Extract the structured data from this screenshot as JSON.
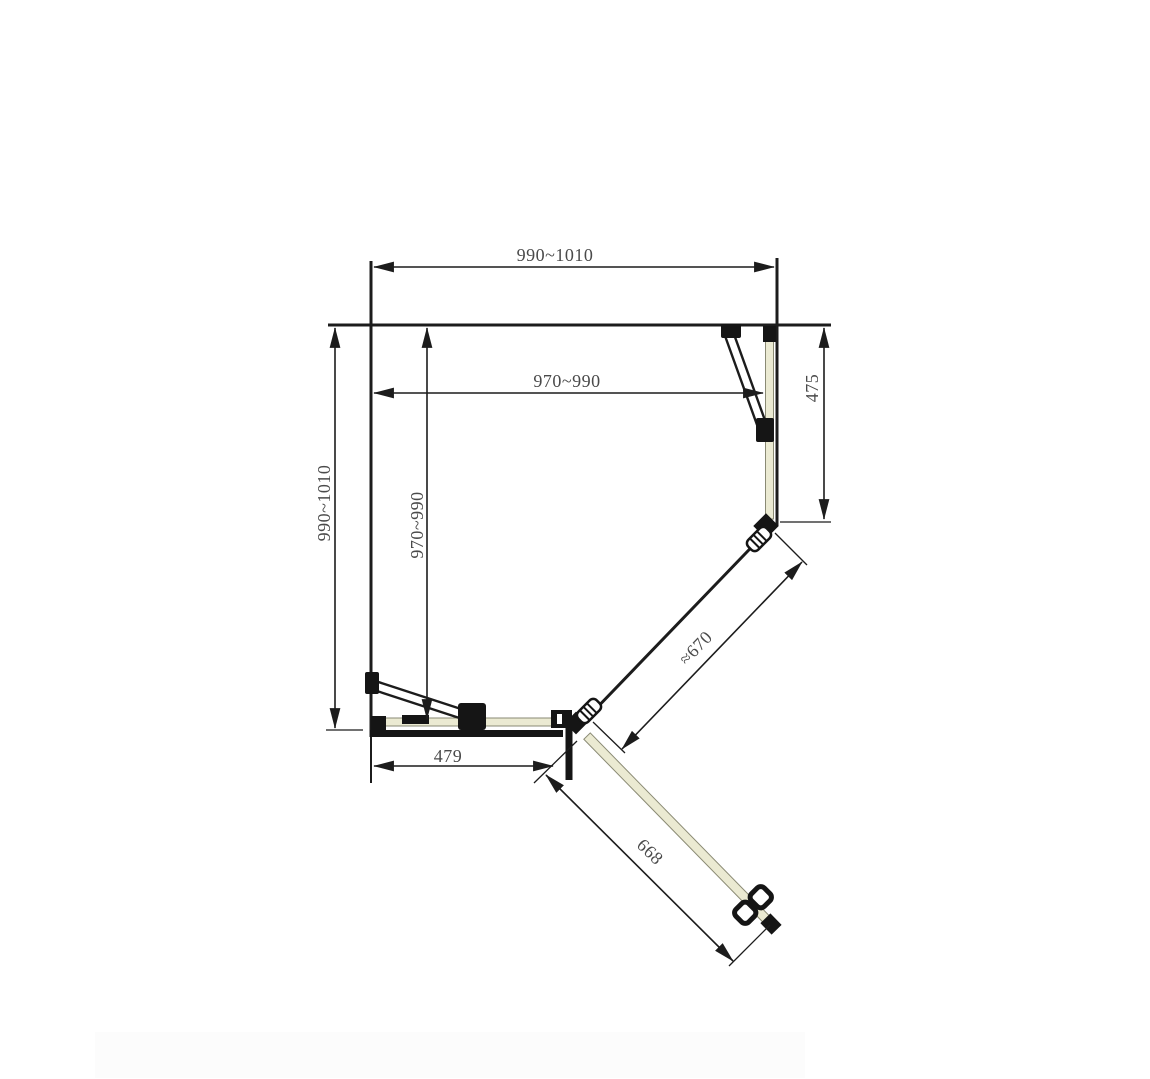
{
  "drawing": {
    "labels": {
      "top_width": "990~1010",
      "inner_width": "970~990",
      "left_height": "990~1010",
      "inner_height": "970~990",
      "right_fixed_panel": "475",
      "angled_fixed_panel": "≈670",
      "bottom_fixed_panel": "479",
      "door_width": "668"
    },
    "colors": {
      "line": "#1c1c1c",
      "glass": "#ebead2",
      "hardware": "#151515",
      "dimension_text": "#4a4a4a",
      "background": "#ffffff"
    }
  }
}
